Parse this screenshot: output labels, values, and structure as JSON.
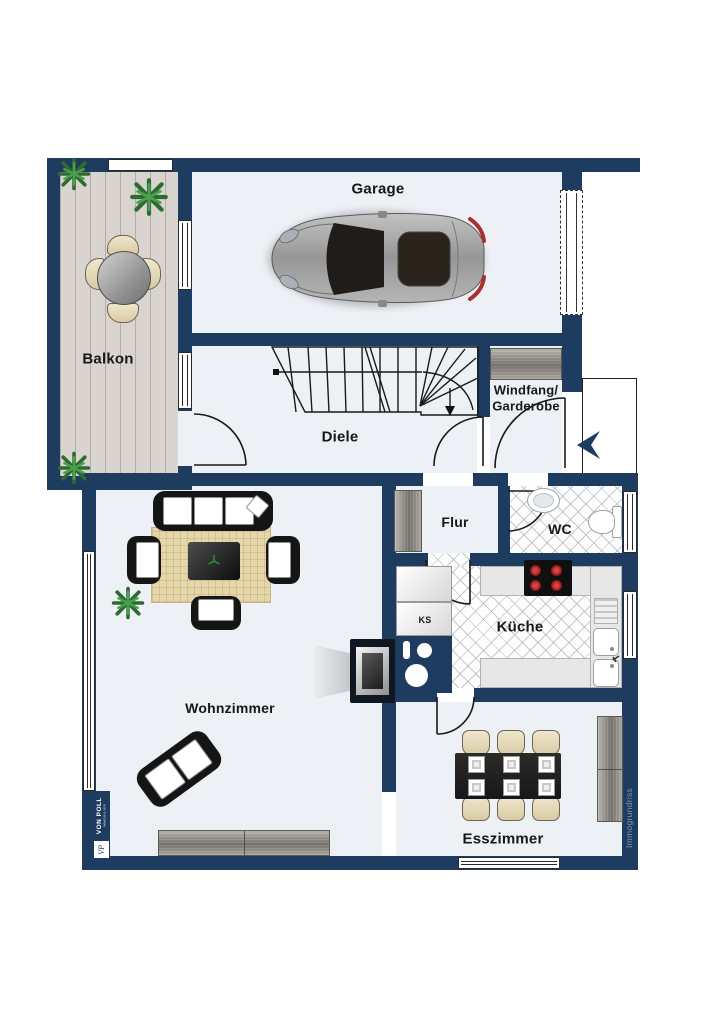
{
  "plan_title": "Erdgeschoss Grundriss",
  "rooms": {
    "garage": {
      "label": "Garage"
    },
    "balkon": {
      "label": "Balkon"
    },
    "diele": {
      "label": "Diele"
    },
    "windfang": {
      "label_line1": "Windfang/",
      "label_line2": "Garderobe"
    },
    "flur": {
      "label": "Flur"
    },
    "wc": {
      "label": "WC"
    },
    "kueche": {
      "label": "Küche"
    },
    "ks": {
      "label": "KS"
    },
    "wohnzimmer": {
      "label": "Wohnzimmer"
    },
    "esszimmer": {
      "label": "Esszimmer"
    }
  },
  "branding": {
    "agency_name": "VON POLL",
    "agency_sub": "IMMOBILIEN",
    "monogram": "VP",
    "watermark": "Immogrundriss"
  },
  "colors": {
    "wall_navy": "#1d3c60",
    "floor": "#edf0f5",
    "balcony_wood": "#d9d4cf",
    "tile_line": "#96a0ac",
    "rug_beige": "#e6d7ab",
    "furniture_wood": "#8e8982",
    "burner_red": "#b02a2a",
    "plant_green": "#2e6b2e",
    "watermark_blue": "#8496ab"
  }
}
